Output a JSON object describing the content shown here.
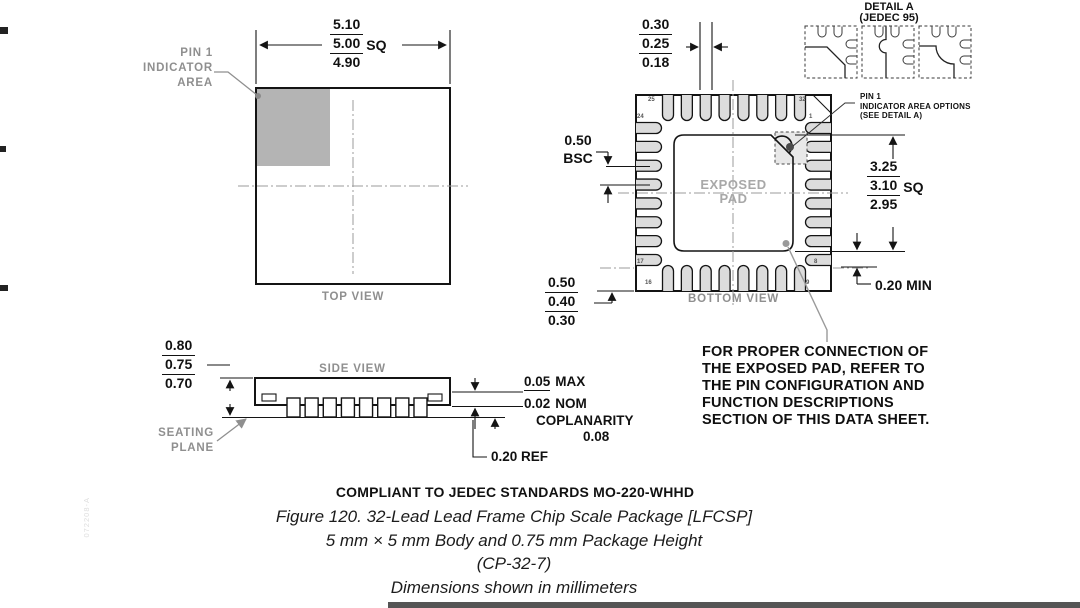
{
  "drawing": {
    "top_view_label": "TOP VIEW",
    "side_view_label": "SIDE VIEW",
    "bottom_view_label": "BOTTOM VIEW",
    "exposed_pad": [
      "EXPOSED",
      "PAD"
    ],
    "pin1_area": [
      "PIN 1",
      "INDICATOR",
      "AREA"
    ],
    "seating_plane": [
      "SEATING",
      "PLANE"
    ],
    "detail_a_title": "DETAIL A",
    "detail_a_sub": "(JEDEC 95)",
    "pin1_options": [
      "PIN 1",
      "INDICATOR AREA OPTIONS",
      "(SEE DETAIL A)"
    ]
  },
  "dims": {
    "body": {
      "values": [
        "5.10",
        "5.00",
        "4.90"
      ],
      "suffix": "SQ"
    },
    "lead_width": {
      "values": [
        "0.30",
        "0.25",
        "0.18"
      ]
    },
    "pitch": {
      "value": "0.50",
      "suffix": "BSC"
    },
    "lead_length": {
      "values": [
        "0.50",
        "0.40",
        "0.30"
      ]
    },
    "pad_size": {
      "values": [
        "3.25",
        "3.10",
        "2.95"
      ],
      "suffix": "SQ"
    },
    "pad_keepout": "0.20 MIN",
    "height": {
      "values": [
        "0.80",
        "0.75",
        "0.70"
      ]
    },
    "standoff_max": {
      "value": "0.05",
      "suffix": "MAX"
    },
    "standoff_nom": {
      "value": "0.02",
      "suffix": "NOM"
    },
    "coplanarity_label": "COPLANARITY",
    "coplanarity_value": "0.08",
    "lead_thickness": "0.20 REF"
  },
  "pins": {
    "p1": "1",
    "p8": "8",
    "p9": "9",
    "p16": "16",
    "p17": "17",
    "p24": "24",
    "p25": "25",
    "p32": "32"
  },
  "note_lines": [
    "FOR PROPER CONNECTION OF",
    "THE EXPOSED PAD, REFER TO",
    "THE PIN CONFIGURATION AND",
    "FUNCTION DESCRIPTIONS",
    "SECTION OF THIS DATA SHEET."
  ],
  "footer": {
    "compliance": "COMPLIANT TO JEDEC STANDARDS MO-220-WHHD",
    "caption": [
      "Figure 120. 32-Lead Lead Frame Chip Scale Package [LFCSP]",
      "5 mm × 5 mm Body and 0.75 mm Package Height",
      "(CP-32-7)",
      "Dimensions shown in millimeters"
    ]
  },
  "watermark": "072208-A"
}
